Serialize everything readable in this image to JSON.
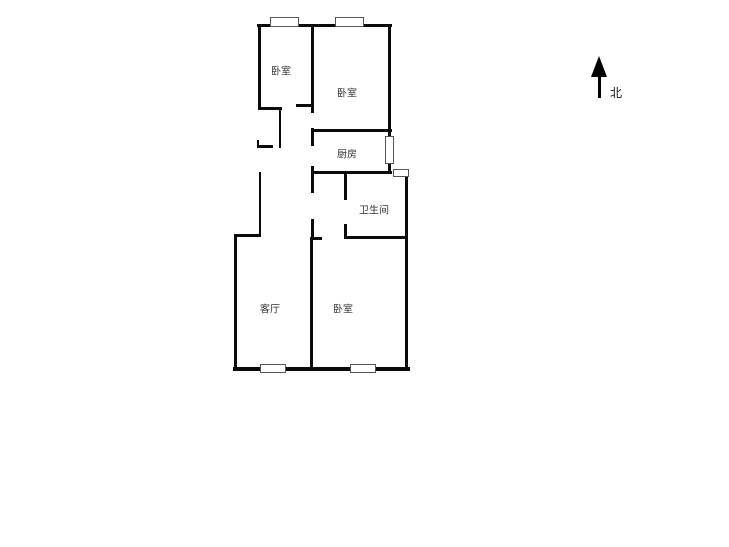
{
  "compass": {
    "label": "北"
  },
  "rooms": [
    {
      "id": "bedroom-1",
      "name": "卧室",
      "x": 281,
      "y": 70
    },
    {
      "id": "bedroom-2",
      "name": "卧室",
      "x": 347,
      "y": 92
    },
    {
      "id": "kitchen",
      "name": "厨房",
      "x": 347,
      "y": 153
    },
    {
      "id": "bathroom",
      "name": "卫生间",
      "x": 374,
      "y": 209
    },
    {
      "id": "living-room",
      "name": "客厅",
      "x": 270,
      "y": 308
    },
    {
      "id": "bedroom-3",
      "name": "卧室",
      "x": 343,
      "y": 308
    }
  ],
  "palette": {
    "wall": "#0b0b0b",
    "background": "#ffffff",
    "window_border": "#555555",
    "label_text": "#333333"
  },
  "geometry": {
    "walls": [
      {
        "x": 257,
        "y": 24,
        "w": 135,
        "h": 3
      },
      {
        "x": 258,
        "y": 107,
        "w": 24,
        "h": 3
      },
      {
        "x": 296,
        "y": 104,
        "w": 18,
        "h": 3
      },
      {
        "x": 257,
        "y": 145,
        "w": 16,
        "h": 3
      },
      {
        "x": 257,
        "y": 140,
        "w": 2,
        "h": 8
      },
      {
        "x": 312,
        "y": 129,
        "w": 80,
        "h": 3
      },
      {
        "x": 312,
        "y": 171,
        "w": 80,
        "h": 3
      },
      {
        "x": 344,
        "y": 236,
        "w": 64,
        "h": 3
      },
      {
        "x": 310,
        "y": 237,
        "w": 12,
        "h": 3
      },
      {
        "x": 234,
        "y": 234,
        "w": 27,
        "h": 3
      },
      {
        "x": 233,
        "y": 367,
        "w": 177,
        "h": 4
      },
      {
        "x": 258,
        "y": 24,
        "w": 3,
        "h": 85
      },
      {
        "x": 279,
        "y": 107,
        "w": 2,
        "h": 41
      },
      {
        "x": 259,
        "y": 172,
        "w": 2,
        "h": 64
      },
      {
        "x": 234,
        "y": 234,
        "w": 3,
        "h": 137
      },
      {
        "x": 311,
        "y": 24,
        "w": 3,
        "h": 89
      },
      {
        "x": 311,
        "y": 128,
        "w": 3,
        "h": 18
      },
      {
        "x": 311,
        "y": 166,
        "w": 3,
        "h": 27
      },
      {
        "x": 311,
        "y": 219,
        "w": 3,
        "h": 21
      },
      {
        "x": 310,
        "y": 237,
        "w": 3,
        "h": 133
      },
      {
        "x": 388,
        "y": 24,
        "w": 3,
        "h": 148
      },
      {
        "x": 405,
        "y": 172,
        "w": 3,
        "h": 199
      },
      {
        "x": 344,
        "y": 174,
        "w": 3,
        "h": 26
      },
      {
        "x": 344,
        "y": 224,
        "w": 3,
        "h": 15
      }
    ],
    "windows": [
      {
        "x": 270,
        "y": 17,
        "w": 29,
        "h": 10
      },
      {
        "x": 335,
        "y": 17,
        "w": 29,
        "h": 10
      },
      {
        "x": 385,
        "y": 136,
        "w": 9,
        "h": 28
      },
      {
        "x": 393,
        "y": 169,
        "w": 16,
        "h": 8
      },
      {
        "x": 260,
        "y": 364,
        "w": 26,
        "h": 9
      },
      {
        "x": 350,
        "y": 364,
        "w": 26,
        "h": 9
      }
    ]
  }
}
